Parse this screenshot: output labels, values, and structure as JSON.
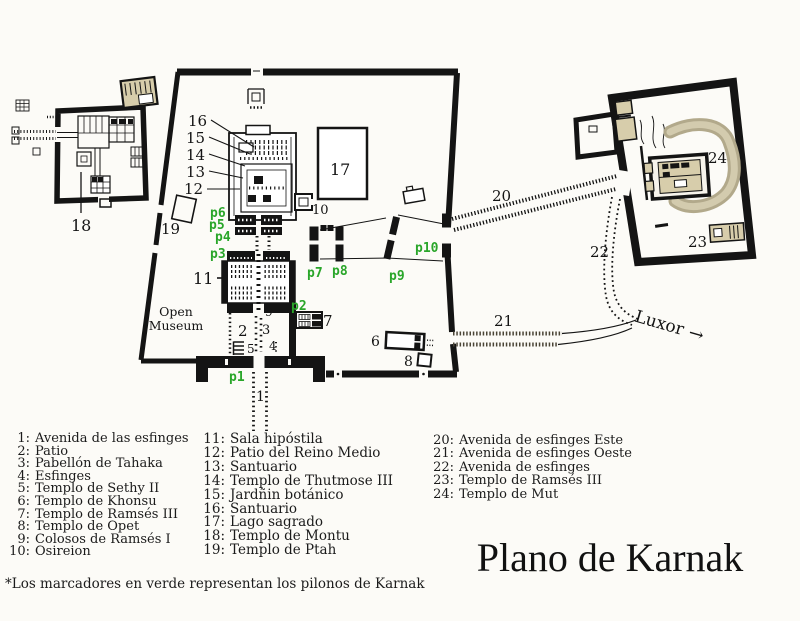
{
  "title": "Plano de Karnak",
  "colors": {
    "green_pylon_marker": "#2aa62a",
    "tan_structure": "#d7cdab",
    "lake_band": "#b2a98b",
    "ink": "#141414",
    "paper": "#fcfbf7",
    "avenue_west": "#4a4436"
  },
  "map": {
    "numbers": {
      "n1": "1",
      "n2": "2",
      "n3": "3",
      "n4": "4",
      "n5": "5",
      "n6": "6",
      "n7": "7",
      "n8": "8",
      "n9": "9",
      "n10": "10",
      "n11": "11",
      "n12": "12",
      "n13": "13",
      "n14": "14",
      "n15": "15",
      "n16": "16",
      "n17": "17",
      "n18": "18",
      "n19": "19",
      "n20": "20",
      "n21": "21",
      "n22": "22",
      "n23": "23",
      "n24": "24"
    },
    "pylons": {
      "p1": "p1",
      "p2": "p2",
      "p3": "p3",
      "p4": "p4",
      "p5": "p5",
      "p6": "p6",
      "p7": "p7",
      "p8": "p8",
      "p9": "p9",
      "p10": "p10"
    },
    "open_museum": {
      "line1": "Open",
      "line2": "Museum"
    },
    "luxor_label": "Luxor",
    "luxor_arrow": "→"
  },
  "legend": {
    "col1": [
      {
        "num": "1:",
        "name": "Avenida de las esfinges"
      },
      {
        "num": "2:",
        "name": "Patio"
      },
      {
        "num": "3:",
        "name": "Pabellón de Tahaka"
      },
      {
        "num": "4:",
        "name": "Esfinges"
      },
      {
        "num": "5:",
        "name": "Templo de Sethy II"
      },
      {
        "num": "6:",
        "name": "Templo de Khonsu"
      },
      {
        "num": "7:",
        "name": "Templo de Ramsés III"
      },
      {
        "num": "8:",
        "name": "Templo de Opet"
      },
      {
        "num": "9:",
        "name": "Colosos de Ramsés I"
      },
      {
        "num": "10:",
        "name": "Osireion"
      }
    ],
    "col2": [
      {
        "num": "11:",
        "name": "Sala hipóstila"
      },
      {
        "num": "12:",
        "name": "Patio del Reino Medio"
      },
      {
        "num": "13:",
        "name": "Santuario"
      },
      {
        "num": "14:",
        "name": "Templo de Thutmose III"
      },
      {
        "num": "15:",
        "name": "Jardñin botánico"
      },
      {
        "num": "16:",
        "name": "Santuario"
      },
      {
        "num": "17:",
        "name": "Lago sagrado"
      },
      {
        "num": "18:",
        "name": "Templo de Montu"
      },
      {
        "num": "19:",
        "name": "Templo de Ptah"
      }
    ],
    "col3": [
      {
        "num": "20:",
        "name": "Avenida de esfinges Este"
      },
      {
        "num": "21:",
        "name": "Avenida de esfinges Oeste"
      },
      {
        "num": "22:",
        "name": "Avenida de esfinges"
      },
      {
        "num": "23:",
        "name": "Templo de Ramsés III"
      },
      {
        "num": "24:",
        "name": "Templo de Mut"
      }
    ],
    "footnote": "*Los marcadores en verde representan los pilonos de Karnak"
  }
}
